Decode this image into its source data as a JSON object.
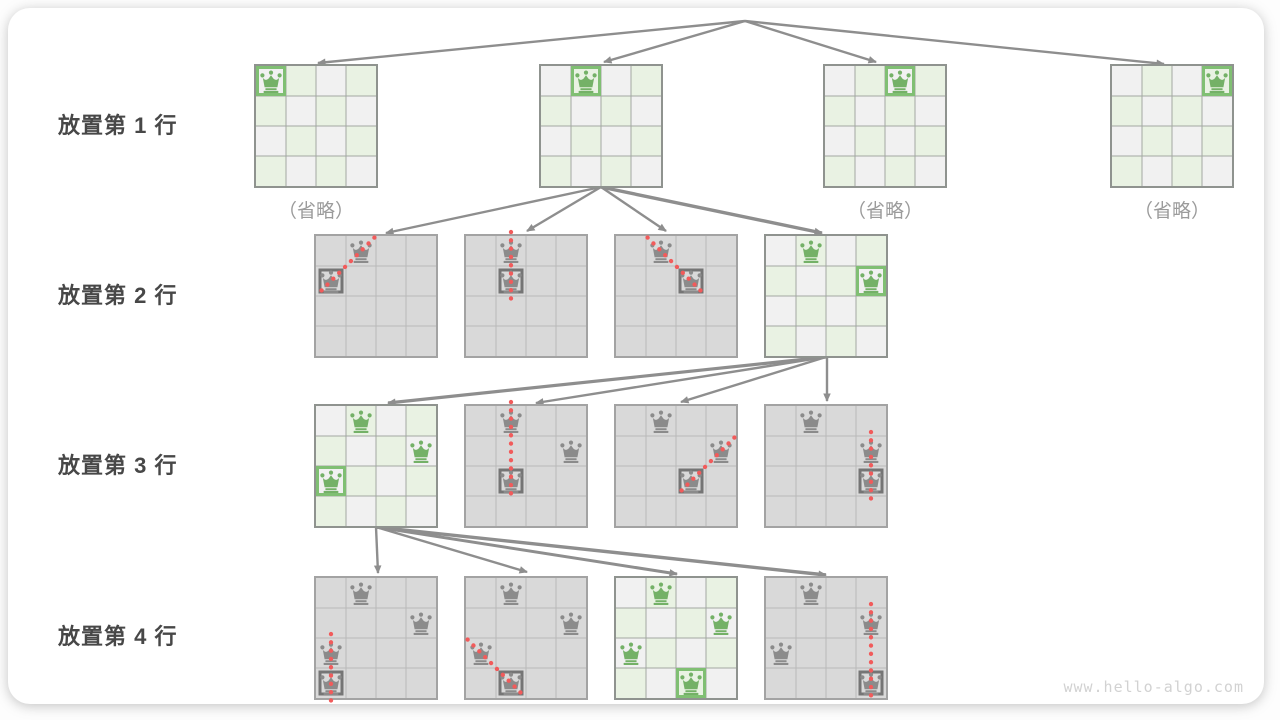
{
  "watermark": "www.hello-algo.com",
  "captions": {
    "omitted": "（省略）"
  },
  "row_labels": [
    {
      "text": "放置第 1 行",
      "y": 126
    },
    {
      "text": "放置第 2 行",
      "y": 296
    },
    {
      "text": "放置第 3 行",
      "y": 466
    },
    {
      "text": "放置第 4 行",
      "y": 637
    }
  ],
  "colors": {
    "queen_green": "#74b167",
    "ring_green": "#80bf73",
    "queen_gray": "#8b8b8b",
    "ring_gray": "#757575",
    "cell_light_gray": "#f1f1f1",
    "cell_light_green": "#e9f2e3",
    "cell_gray": "#d9d9d9",
    "grid_light": "#a3a8a2",
    "grid_gray": "#b9b9b9",
    "board_border_light": "#8f938f",
    "board_border_gray": "#a3a3a3",
    "arrow": "#8e8e8e",
    "conflict_red": "#f15b5b"
  },
  "board_geometry": {
    "cell": 30,
    "size": 120
  },
  "boards": [
    {
      "name": "row1-col0",
      "x": 256,
      "y": 66,
      "style": "light",
      "caption": true,
      "queens": [
        {
          "r": 0,
          "c": 0,
          "color": "green",
          "ring": "green"
        }
      ]
    },
    {
      "name": "row1-col1",
      "x": 541,
      "y": 66,
      "style": "light",
      "queens": [
        {
          "r": 0,
          "c": 1,
          "color": "green",
          "ring": "green"
        }
      ]
    },
    {
      "name": "row1-col2",
      "x": 825,
      "y": 66,
      "style": "light",
      "caption": true,
      "queens": [
        {
          "r": 0,
          "c": 2,
          "color": "green",
          "ring": "green"
        }
      ]
    },
    {
      "name": "row1-col3",
      "x": 1112,
      "y": 66,
      "style": "light",
      "caption": true,
      "queens": [
        {
          "r": 0,
          "c": 3,
          "color": "green",
          "ring": "green"
        }
      ]
    },
    {
      "name": "row2-try-col0",
      "x": 316,
      "y": 236,
      "style": "gray",
      "queens": [
        {
          "r": 0,
          "c": 1,
          "color": "gray"
        },
        {
          "r": 1,
          "c": 0,
          "color": "gray",
          "ring": "gray"
        }
      ],
      "conflict": {
        "from": [
          0,
          1
        ],
        "to": [
          1,
          0
        ]
      }
    },
    {
      "name": "row2-try-col1",
      "x": 466,
      "y": 236,
      "style": "gray",
      "queens": [
        {
          "r": 0,
          "c": 1,
          "color": "gray"
        },
        {
          "r": 1,
          "c": 1,
          "color": "gray",
          "ring": "gray"
        }
      ],
      "conflict": {
        "from": [
          0,
          1
        ],
        "to": [
          1,
          1
        ]
      }
    },
    {
      "name": "row2-try-col2",
      "x": 616,
      "y": 236,
      "style": "gray",
      "queens": [
        {
          "r": 0,
          "c": 1,
          "color": "gray"
        },
        {
          "r": 1,
          "c": 2,
          "color": "gray",
          "ring": "gray"
        }
      ],
      "conflict": {
        "from": [
          0,
          1
        ],
        "to": [
          1,
          2
        ]
      }
    },
    {
      "name": "row2-try-col3",
      "x": 766,
      "y": 236,
      "style": "light",
      "queens": [
        {
          "r": 0,
          "c": 1,
          "color": "green"
        },
        {
          "r": 1,
          "c": 3,
          "color": "green",
          "ring": "green"
        }
      ]
    },
    {
      "name": "row3-try-col0",
      "x": 316,
      "y": 406,
      "style": "light",
      "queens": [
        {
          "r": 0,
          "c": 1,
          "color": "green"
        },
        {
          "r": 1,
          "c": 3,
          "color": "green"
        },
        {
          "r": 2,
          "c": 0,
          "color": "green",
          "ring": "green"
        }
      ]
    },
    {
      "name": "row3-try-col1",
      "x": 466,
      "y": 406,
      "style": "gray",
      "queens": [
        {
          "r": 0,
          "c": 1,
          "color": "gray"
        },
        {
          "r": 1,
          "c": 3,
          "color": "gray"
        },
        {
          "r": 2,
          "c": 1,
          "color": "gray",
          "ring": "gray"
        }
      ],
      "conflict": {
        "from": [
          0,
          1
        ],
        "to": [
          2,
          1
        ]
      }
    },
    {
      "name": "row3-try-col2",
      "x": 616,
      "y": 406,
      "style": "gray",
      "queens": [
        {
          "r": 0,
          "c": 1,
          "color": "gray"
        },
        {
          "r": 1,
          "c": 3,
          "color": "gray"
        },
        {
          "r": 2,
          "c": 2,
          "color": "gray",
          "ring": "gray"
        }
      ],
      "conflict": {
        "from": [
          1,
          3
        ],
        "to": [
          2,
          2
        ]
      }
    },
    {
      "name": "row3-try-col3",
      "x": 766,
      "y": 406,
      "style": "gray",
      "queens": [
        {
          "r": 0,
          "c": 1,
          "color": "gray"
        },
        {
          "r": 1,
          "c": 3,
          "color": "gray"
        },
        {
          "r": 2,
          "c": 3,
          "color": "gray",
          "ring": "gray"
        }
      ],
      "conflict": {
        "from": [
          1,
          3
        ],
        "to": [
          2,
          3
        ]
      }
    },
    {
      "name": "row4-try-col0",
      "x": 316,
      "y": 578,
      "style": "gray",
      "queens": [
        {
          "r": 0,
          "c": 1,
          "color": "gray"
        },
        {
          "r": 1,
          "c": 3,
          "color": "gray"
        },
        {
          "r": 2,
          "c": 0,
          "color": "gray"
        },
        {
          "r": 3,
          "c": 0,
          "color": "gray",
          "ring": "gray"
        }
      ],
      "conflict": {
        "from": [
          2,
          0
        ],
        "to": [
          3,
          0
        ]
      }
    },
    {
      "name": "row4-try-col1",
      "x": 466,
      "y": 578,
      "style": "gray",
      "queens": [
        {
          "r": 0,
          "c": 1,
          "color": "gray"
        },
        {
          "r": 1,
          "c": 3,
          "color": "gray"
        },
        {
          "r": 2,
          "c": 0,
          "color": "gray"
        },
        {
          "r": 3,
          "c": 1,
          "color": "gray",
          "ring": "gray"
        }
      ],
      "conflict": {
        "from": [
          2,
          0
        ],
        "to": [
          3,
          1
        ]
      }
    },
    {
      "name": "row4-try-col2-solution",
      "x": 616,
      "y": 578,
      "style": "light",
      "queens": [
        {
          "r": 0,
          "c": 1,
          "color": "green"
        },
        {
          "r": 1,
          "c": 3,
          "color": "green"
        },
        {
          "r": 2,
          "c": 0,
          "color": "green"
        },
        {
          "r": 3,
          "c": 2,
          "color": "green",
          "ring": "green"
        }
      ]
    },
    {
      "name": "row4-try-col3",
      "x": 766,
      "y": 578,
      "style": "gray",
      "queens": [
        {
          "r": 0,
          "c": 1,
          "color": "gray"
        },
        {
          "r": 1,
          "c": 3,
          "color": "gray"
        },
        {
          "r": 2,
          "c": 0,
          "color": "gray"
        },
        {
          "r": 3,
          "c": 3,
          "color": "gray",
          "ring": "gray"
        }
      ],
      "conflict": {
        "from": [
          1,
          3
        ],
        "to": [
          3,
          3
        ]
      }
    }
  ],
  "arrows": [
    {
      "x1": 745,
      "y1": 21,
      "x2": 318,
      "y2": 63
    },
    {
      "x1": 745,
      "y1": 21,
      "x2": 604,
      "y2": 62
    },
    {
      "x1": 745,
      "y1": 21,
      "x2": 876,
      "y2": 62
    },
    {
      "x1": 745,
      "y1": 21,
      "x2": 1164,
      "y2": 64
    },
    {
      "x1": 601,
      "y1": 187,
      "x2": 386,
      "y2": 233
    },
    {
      "x1": 601,
      "y1": 187,
      "x2": 527,
      "y2": 231
    },
    {
      "x1": 601,
      "y1": 187,
      "x2": 666,
      "y2": 231
    },
    {
      "x1": 601,
      "y1": 187,
      "x2": 822,
      "y2": 233,
      "w": 3.4
    },
    {
      "x1": 826,
      "y1": 357,
      "x2": 388,
      "y2": 403,
      "w": 3.2
    },
    {
      "x1": 826,
      "y1": 357,
      "x2": 536,
      "y2": 403
    },
    {
      "x1": 826,
      "y1": 357,
      "x2": 681,
      "y2": 402
    },
    {
      "x1": 827,
      "y1": 357,
      "x2": 827,
      "y2": 401
    },
    {
      "x1": 376,
      "y1": 527,
      "x2": 378,
      "y2": 573
    },
    {
      "x1": 376,
      "y1": 527,
      "x2": 527,
      "y2": 572
    },
    {
      "x1": 376,
      "y1": 527,
      "x2": 677,
      "y2": 574,
      "w": 3.0
    },
    {
      "x1": 376,
      "y1": 527,
      "x2": 826,
      "y2": 575,
      "w": 3.4
    }
  ]
}
